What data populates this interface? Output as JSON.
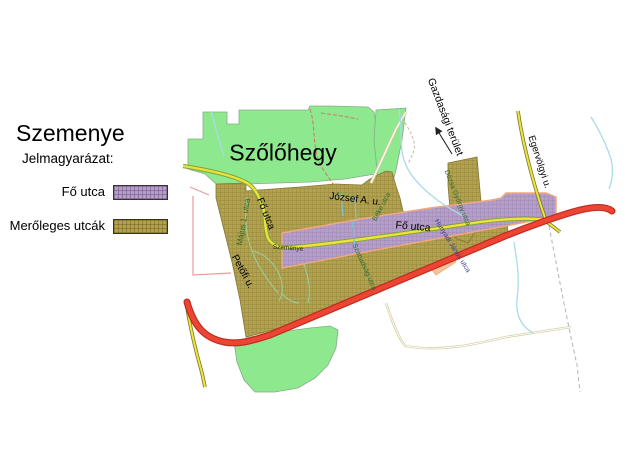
{
  "legend": {
    "title": "Szemenye",
    "subtitle": "Jelmagyarázat:",
    "items": [
      {
        "label": "Fő utca",
        "color": "#b59fc8"
      },
      {
        "label": "Merőleges utcák",
        "color": "#b2a24e"
      }
    ]
  },
  "map": {
    "area_labels": {
      "szolohegy": "Szőlőhegy",
      "gazdasagi_terulet": "Gazdasági terület"
    },
    "street_labels": {
      "fo_utca_west": "Fő utca",
      "fo_utca_center": "Fő utca",
      "jozsef": "József A. u.",
      "majus": "Május 1. utca",
      "petofi": "Petőfi u.",
      "szemenye_road": "Szemenye",
      "beke": "Béke utca",
      "szabadsag": "Szabadság utca",
      "dozsa": "Dózsa György utca",
      "hunyadi": "Hunyadi János utca",
      "egervolgyi": "Egervölgyi u."
    },
    "colors": {
      "vineyard_green": "#8ee88e",
      "perpendicular_olive": "#b2a24e",
      "main_street_purple": "#b59fc8",
      "main_road_red": "#ee4433",
      "secondary_road_yellow": "#f0e43c",
      "creek_blue": "#a8dce8",
      "band_outline_peach": "#f0a87c"
    }
  }
}
